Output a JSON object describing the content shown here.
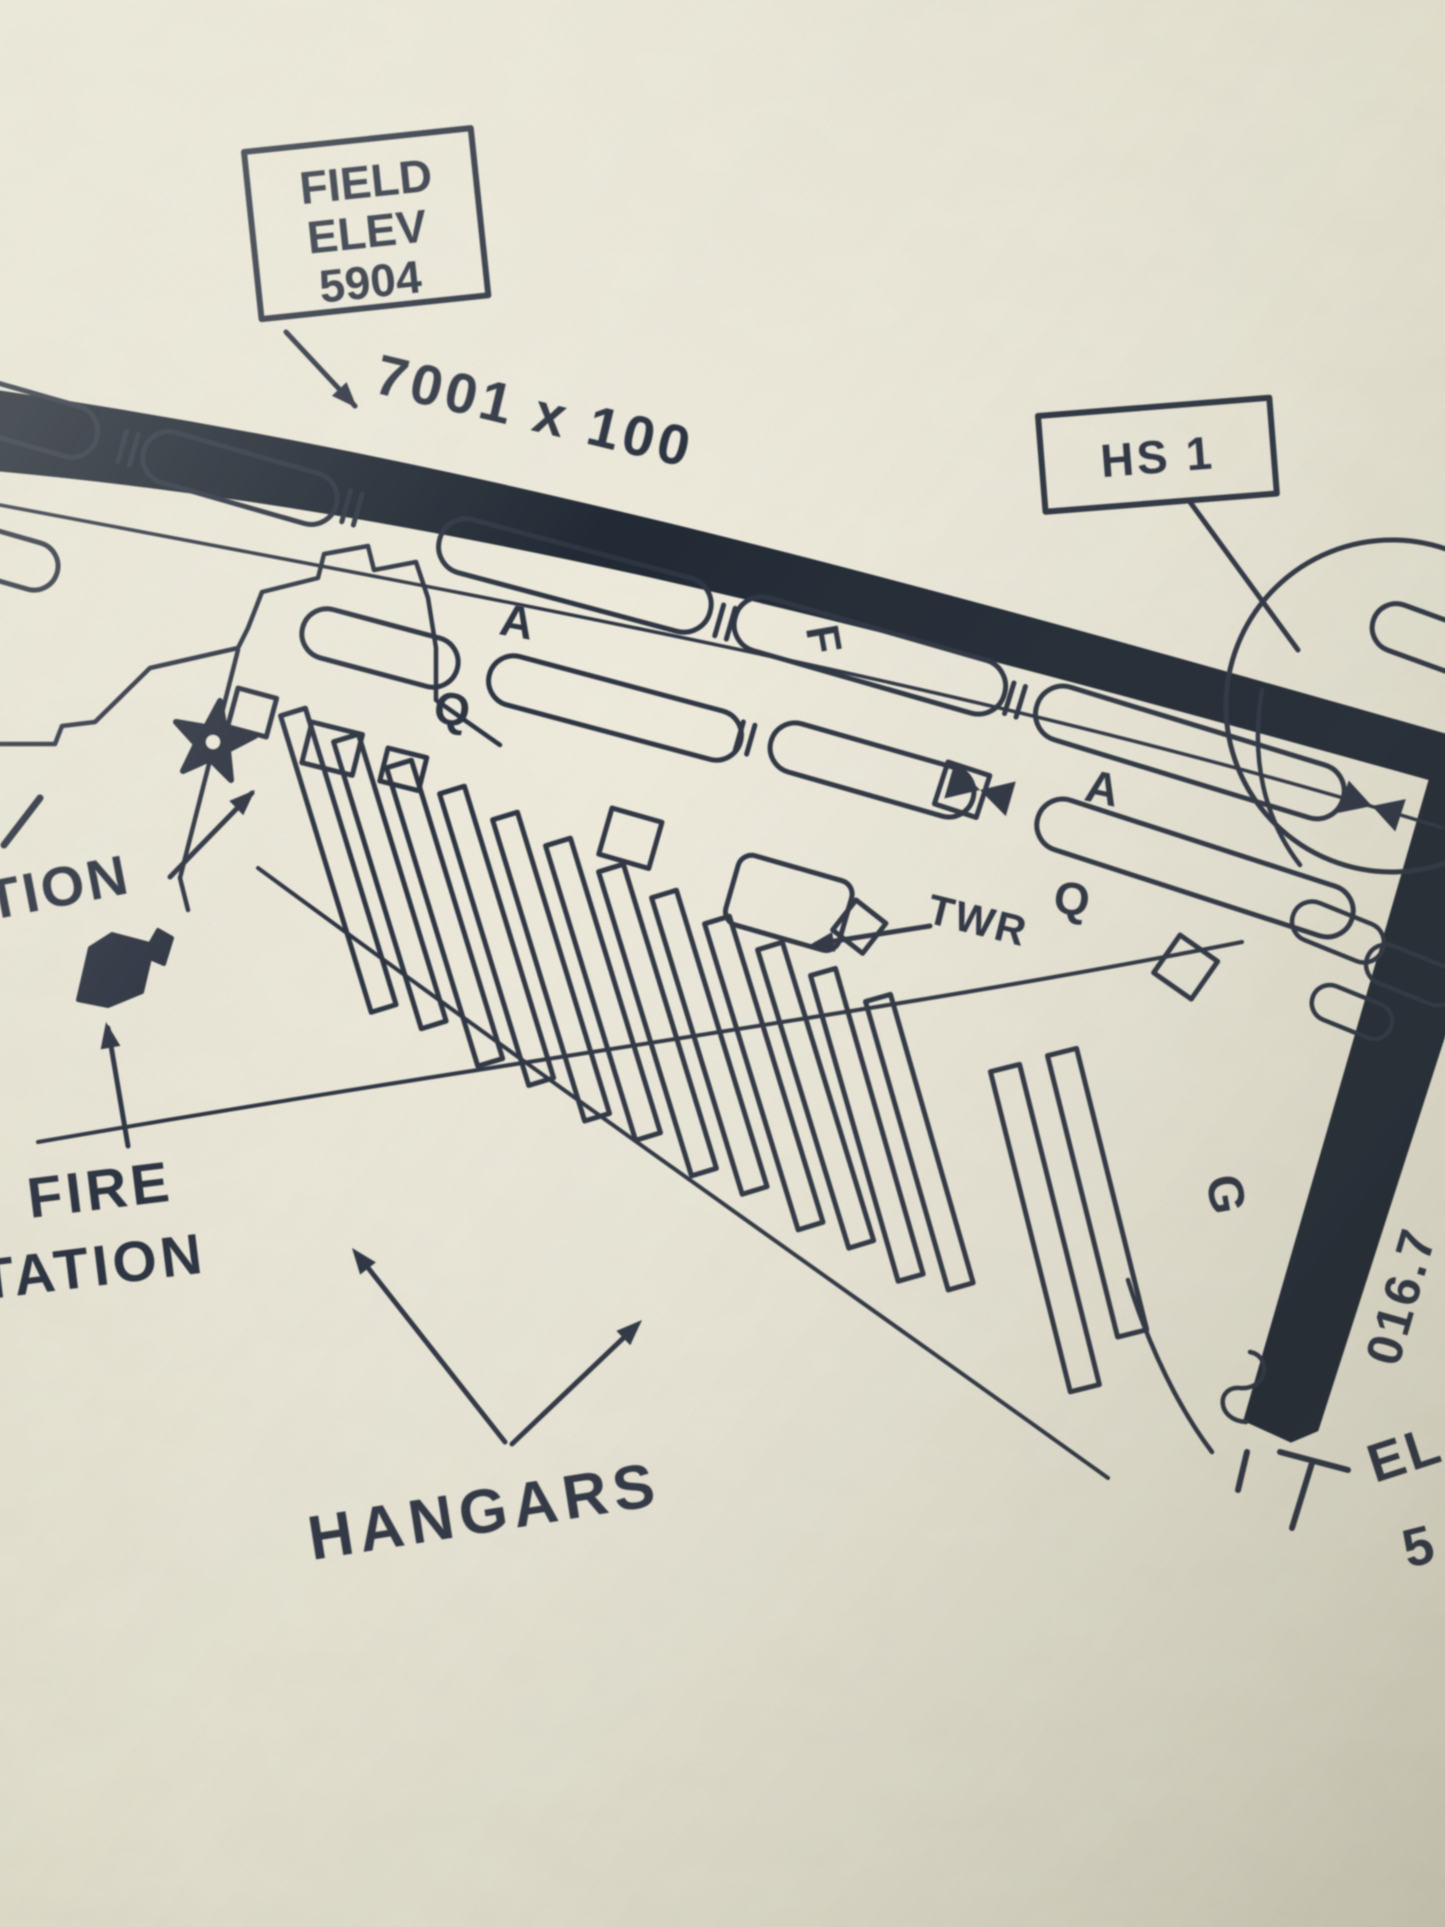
{
  "colors": {
    "paper": "#eae7d8",
    "paper_light": "#f2efe2",
    "paper_shadow": "#d9d5c3",
    "ink": "#2e3543",
    "ink_heavy": "#232834"
  },
  "field_elev_box": {
    "line1": "FIELD",
    "line2": "ELEV",
    "line3": "5904"
  },
  "runway": {
    "dimensions": "7001 x 100",
    "crossing_heading": "016.7",
    "end_elev_partial_line1": "EL",
    "end_elev_partial_line2": "5"
  },
  "hotspot": {
    "label": "HS 1"
  },
  "taxiways": {
    "a_upper": "A",
    "q_upper": "Q",
    "f": "F",
    "a_right": "A",
    "q_right": "Q",
    "g": "G"
  },
  "labels": {
    "tower": "TWR",
    "fire_line1": "FIRE",
    "fire_line2": "STATION",
    "hangars": "HANGARS",
    "partial_left": "TION"
  },
  "icons": {
    "beacon": "star-icon",
    "fire_station_symbol": "flag-icon",
    "hold_marker": "bowtie-icon"
  }
}
